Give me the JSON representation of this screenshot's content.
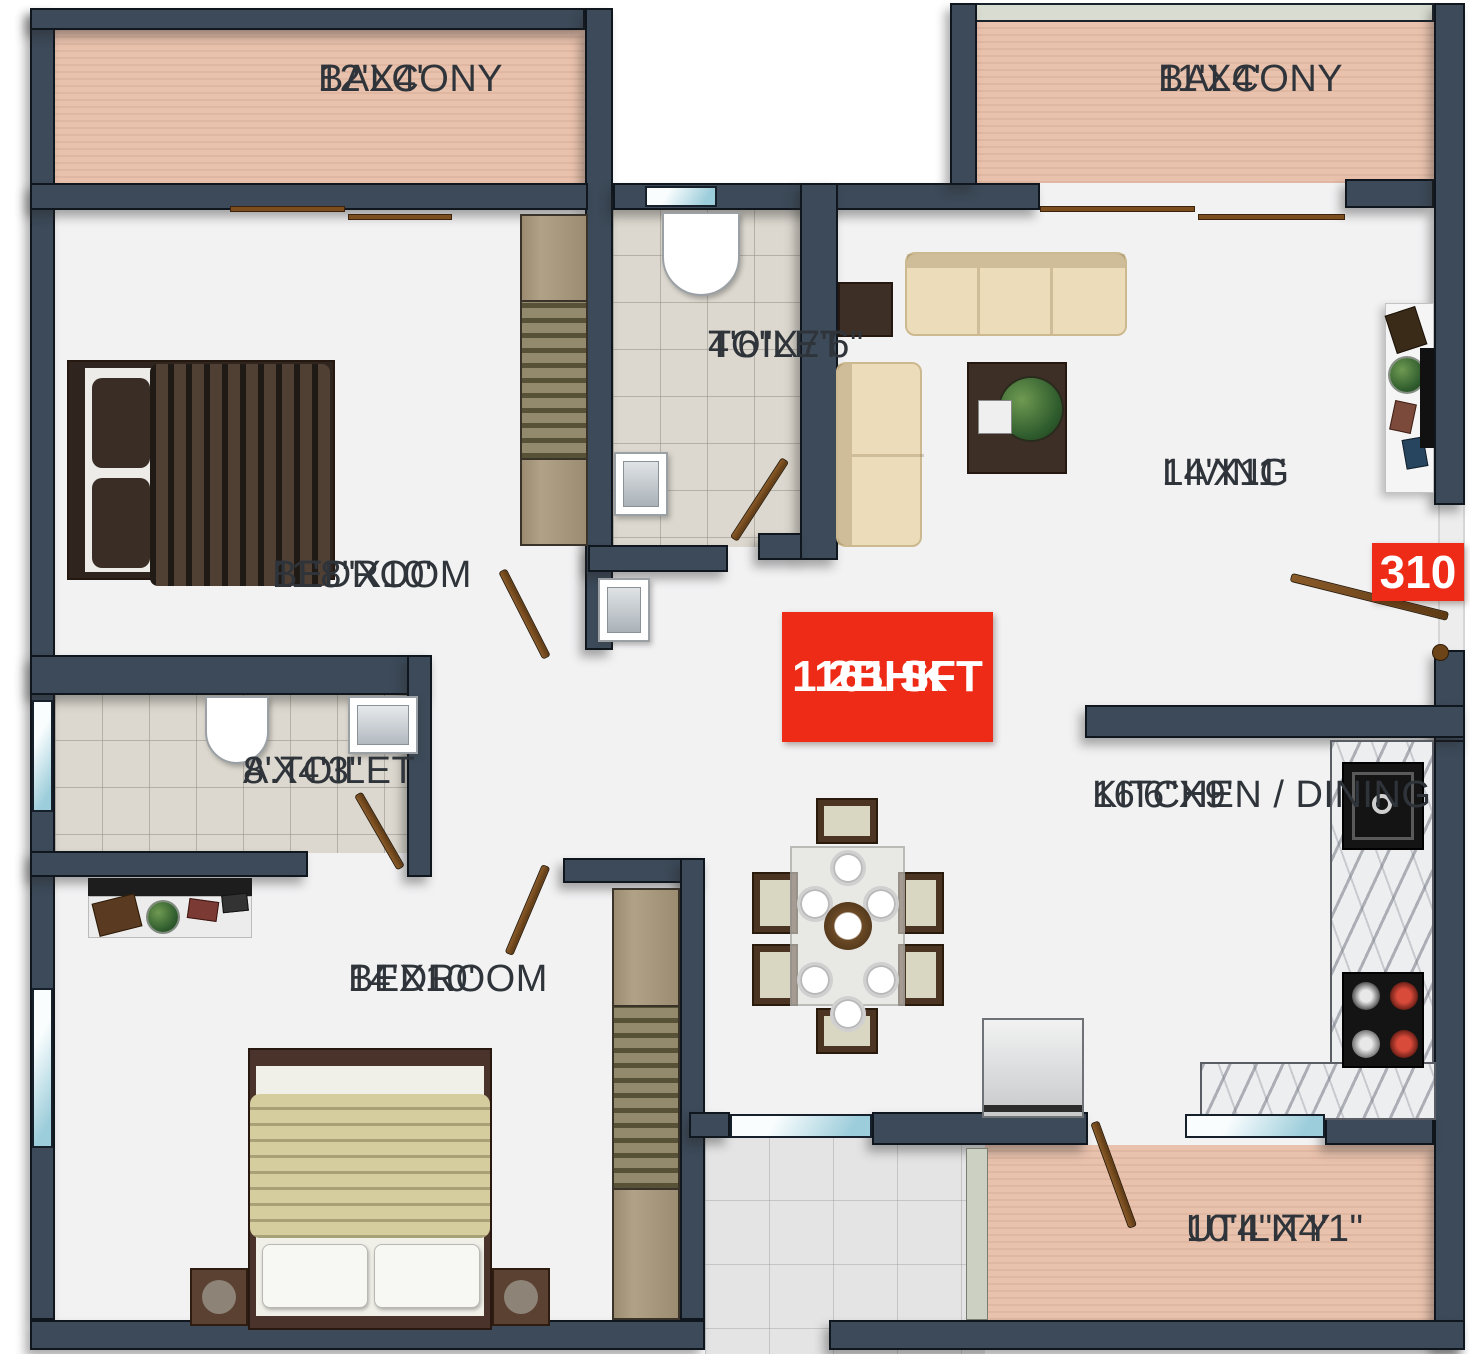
{
  "plan": {
    "badges": {
      "unit_number": "310",
      "unit_type": "2BHK",
      "unit_area": "1161 SFT"
    },
    "rooms": {
      "balcony_top_left": {
        "name": "BALCONY",
        "dims": "12'X4'"
      },
      "balcony_top_right": {
        "name": "BALCONY",
        "dims": "11'X4'"
      },
      "bedroom_1": {
        "name": "BEDROOM",
        "dims": "11'8\"X10'"
      },
      "toilet": {
        "name": "TOILET",
        "dims": "4'6\"X7'6\""
      },
      "living": {
        "name": "LIVING",
        "dims": "14'X11'"
      },
      "attached_toilet": {
        "name": "A.TOILET",
        "dims": "8'X4'3\""
      },
      "bedroom_2": {
        "name": "BEDROOM",
        "dims": "14'X10'"
      },
      "kitchen_dining": {
        "name": "KITCHEN / DINING",
        "dims": "16'6\"X9'"
      },
      "utility": {
        "name": "UTILITY",
        "dims": "10'4\"X4'1\""
      }
    },
    "colors": {
      "wall": "#3c4a59",
      "balcony_floor": "#e9c2ad",
      "toilet_floor": "#dcd8cf",
      "badge_red": "#ee2b16",
      "window": "#c9ecf7",
      "door_wood": "#7c4e1f",
      "label_text": "#2f343a"
    }
  }
}
